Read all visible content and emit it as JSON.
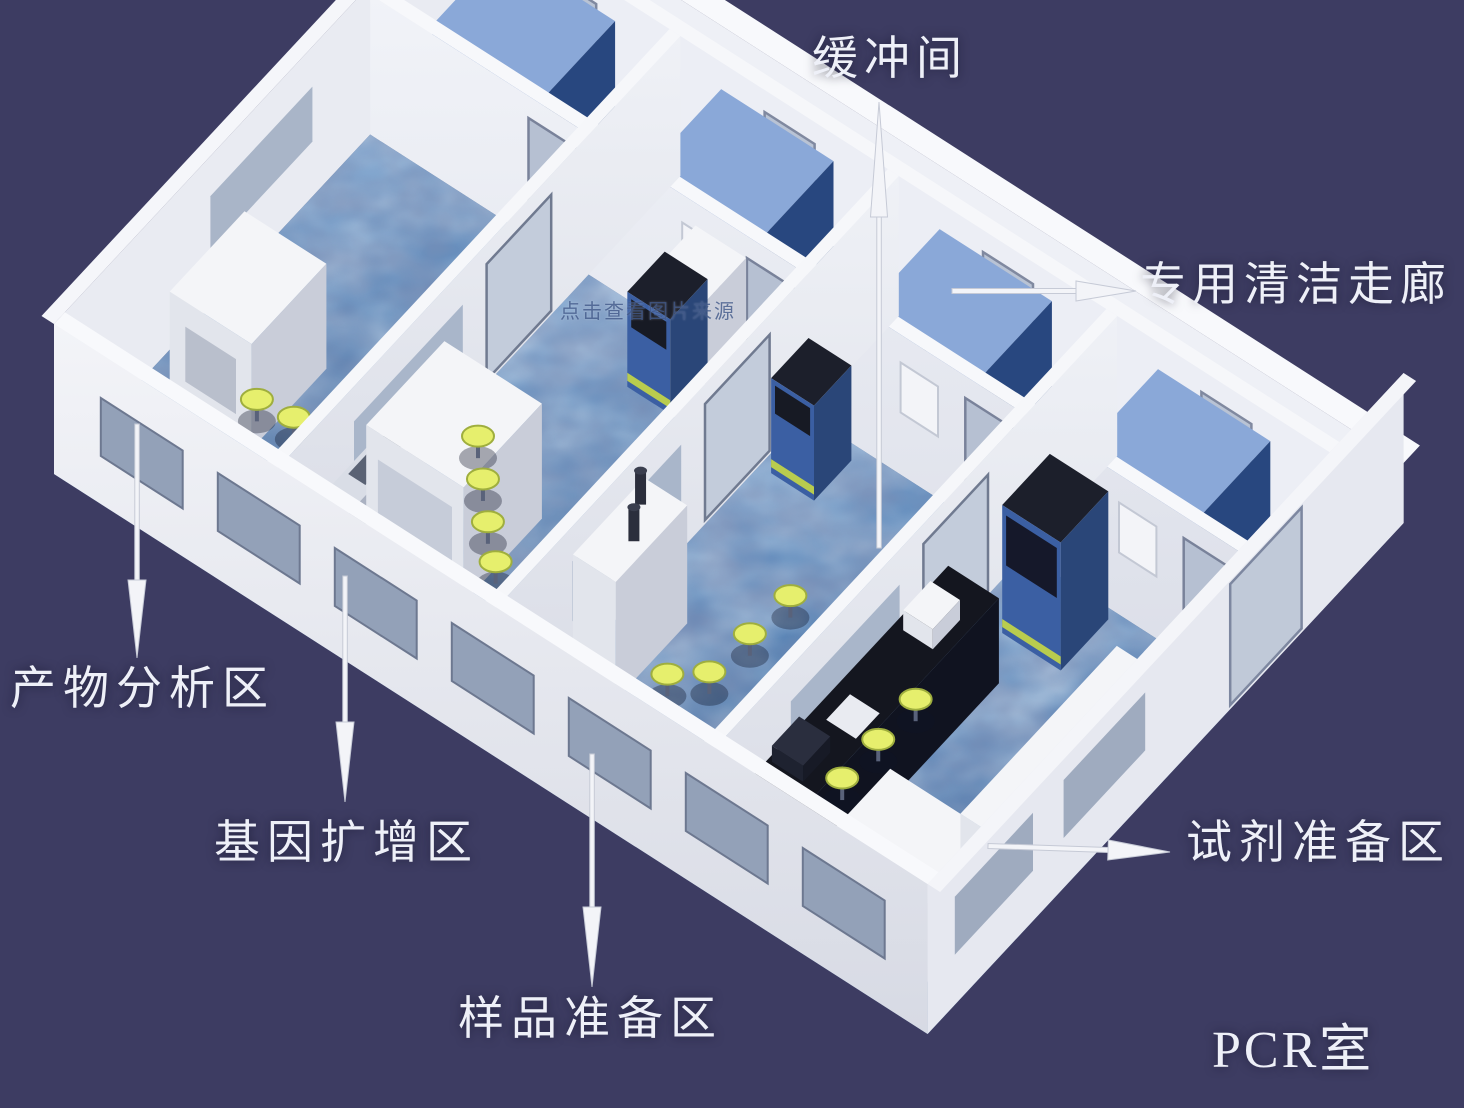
{
  "diagram": {
    "type": "isometric-pcr-lab-floor-plan",
    "title": "PCR室",
    "watermark": "点击查看图片来源",
    "labels": {
      "buffer_room": "缓冲间",
      "clean_corridor": "专用清洁走廊",
      "product_analysis": "产物分析区",
      "gene_amplification": "基因扩增区",
      "sample_preparation": "样品准备区",
      "reagent_preparation": "试剂准备区"
    },
    "colors": {
      "background": "#3d3c62",
      "floor_blue": "#5d87b8",
      "wall_white": "#eef0f6",
      "cabinet_blue": "#3c63ad",
      "stool_yellow": "#e6ef6d",
      "label_text": "#eef0f8"
    }
  }
}
